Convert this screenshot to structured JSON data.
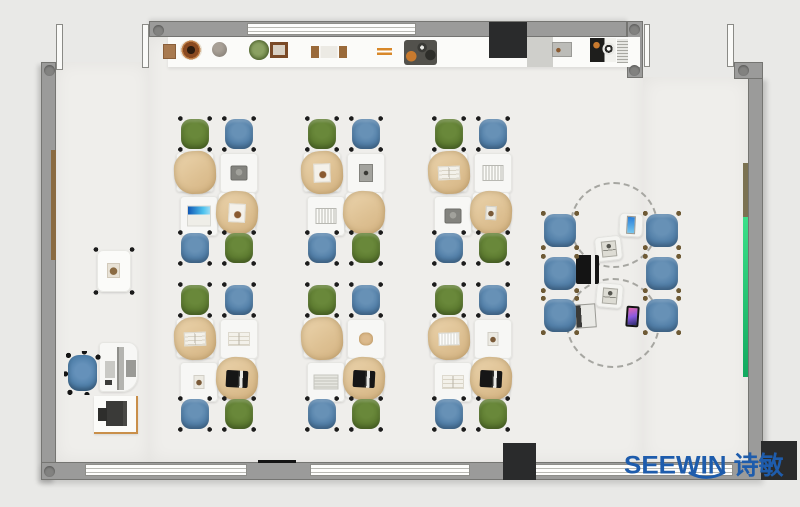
{
  "logo": {
    "text": "SEEWIN",
    "cn": "诗敏"
  },
  "palette": {
    "outside": "#e9e9e7",
    "floor": "#efeeeb",
    "wall": "#9b9b9a",
    "wall-line": "#757572",
    "chair-green": "#5d7b30",
    "chair-blue": "#527fa8",
    "bag": "#e2c79f",
    "desk": "#f7f7f5",
    "board-green": "#2fd984",
    "board-brown": "#7b7252",
    "brand": "#1e5cac",
    "accent-black": "#2a2b2c"
  },
  "shelf": {
    "items": [
      {
        "type": "box",
        "x": 163,
        "y": 44
      },
      {
        "type": "bowl",
        "x": 180,
        "y": 40
      },
      {
        "type": "sphere",
        "x": 212,
        "y": 42
      },
      {
        "type": "plant",
        "x": 249,
        "y": 40
      },
      {
        "type": "frame",
        "x": 270,
        "y": 42
      },
      {
        "type": "bookends",
        "x": 311,
        "y": 46
      },
      {
        "type": "sticks",
        "x": 377,
        "y": 48
      },
      {
        "type": "tray",
        "x": 404,
        "y": 40
      },
      {
        "type": "graybox",
        "x": 552,
        "y": 42
      },
      {
        "type": "appliance",
        "x": 590,
        "y": 38
      },
      {
        "type": "vent",
        "x": 617,
        "y": 39
      }
    ]
  },
  "cluster_layout": {
    "chairs": [
      {
        "dx": 4,
        "dy": 0,
        "color": "green"
      },
      {
        "dx": 48,
        "dy": 0,
        "color": "blue"
      },
      {
        "dx": 4,
        "dy": 114,
        "color": "blue"
      },
      {
        "dx": 48,
        "dy": 114,
        "color": "green"
      }
    ],
    "desks": [
      {
        "pos": "tl",
        "dx": 0,
        "dy": 34,
        "tan": true,
        "rot": -2
      },
      {
        "pos": "tr",
        "dx": 44,
        "dy": 35,
        "tan": false,
        "rot": 0
      },
      {
        "pos": "bl",
        "dx": 4,
        "dy": 78,
        "tan": false,
        "rot": 0
      },
      {
        "pos": "br",
        "dx": 42,
        "dy": 74,
        "tan": true,
        "rot": 3
      }
    ]
  },
  "clusters": [
    {
      "x": 176,
      "y": 118,
      "devices": {
        "tl": "none",
        "tr": "laptop-gray",
        "bl": "screen-blue",
        "br": "paper-sketch"
      }
    },
    {
      "x": 303,
      "y": 118,
      "devices": {
        "tl": "paper-sketch",
        "tr": "tablet-dark",
        "bl": "book-striped",
        "br": "none"
      }
    },
    {
      "x": 430,
      "y": 118,
      "devices": {
        "tl": "book-open",
        "tr": "book-striped",
        "bl": "laptop-gray",
        "br": "photo-small"
      }
    },
    {
      "x": 176,
      "y": 284,
      "devices": {
        "tl": "book-open",
        "tr": "book-open",
        "bl": "photo-small",
        "br": "laptop-black"
      }
    },
    {
      "x": 303,
      "y": 284,
      "devices": {
        "tl": "none",
        "tr": "bag-icon",
        "bl": "newspaper",
        "br": "laptop-black"
      }
    },
    {
      "x": 430,
      "y": 284,
      "devices": {
        "tl": "keyboard-white",
        "tr": "photo-small",
        "bl": "book-open",
        "br": "laptop-black"
      }
    }
  ],
  "collab": {
    "circles": [
      {
        "x": 570,
        "y": 182,
        "w": 88,
        "h": 86
      },
      {
        "x": 566,
        "y": 278,
        "w": 94,
        "h": 90
      }
    ],
    "chairs": [
      {
        "x": 543,
        "y": 213
      },
      {
        "x": 645,
        "y": 213
      },
      {
        "x": 543,
        "y": 256
      },
      {
        "x": 645,
        "y": 256
      },
      {
        "x": 543,
        "y": 298
      },
      {
        "x": 645,
        "y": 298
      }
    ],
    "items": [
      {
        "type": "table",
        "x": 619,
        "y": 213,
        "w": 24,
        "h": 24,
        "rot": 3,
        "device": "tablet-blue"
      },
      {
        "type": "table",
        "x": 595,
        "y": 236,
        "w": 27,
        "h": 25,
        "rot": -6,
        "device": "laptop-sketch"
      },
      {
        "type": "laptop-black",
        "x": 576,
        "y": 255,
        "rot": 0
      },
      {
        "type": "table",
        "x": 596,
        "y": 283,
        "w": 27,
        "h": 25,
        "rot": 5,
        "device": "laptop-sketch"
      },
      {
        "type": "laptop-white",
        "x": 575,
        "y": 304,
        "rot": -4
      },
      {
        "type": "tablet-pink",
        "x": 626,
        "y": 306,
        "rot": 4
      }
    ]
  }
}
